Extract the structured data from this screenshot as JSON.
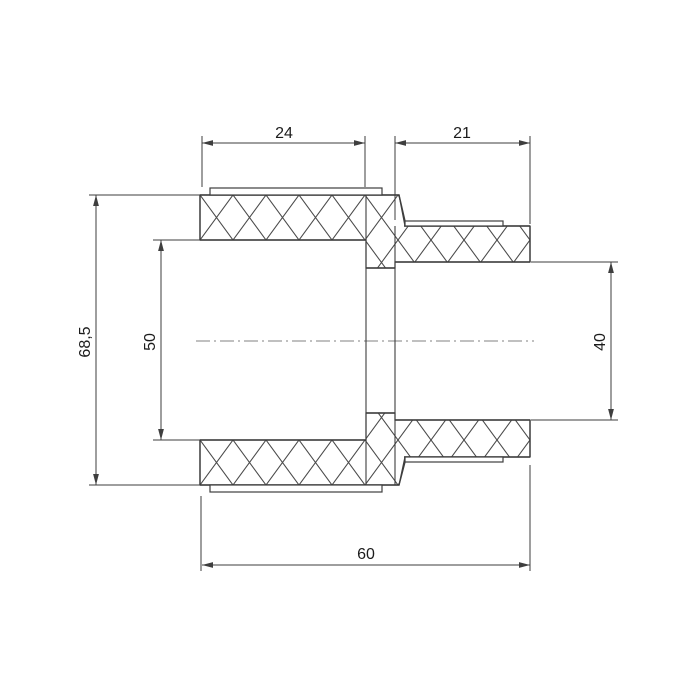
{
  "drawing": {
    "kind": "technical-section-drawing",
    "dimensions": {
      "socket_left_depth": "24",
      "socket_right_depth": "21",
      "total_length": "60",
      "outer_diameter": "68,5",
      "left_bore_diameter": "50",
      "right_bore_diameter": "40"
    },
    "colors": {
      "outline": "#3e3e3e",
      "hatch": "#4a4a4a",
      "centerline": "#9a9a9a",
      "text": "#1c1c1c",
      "background": "#ffffff"
    }
  }
}
